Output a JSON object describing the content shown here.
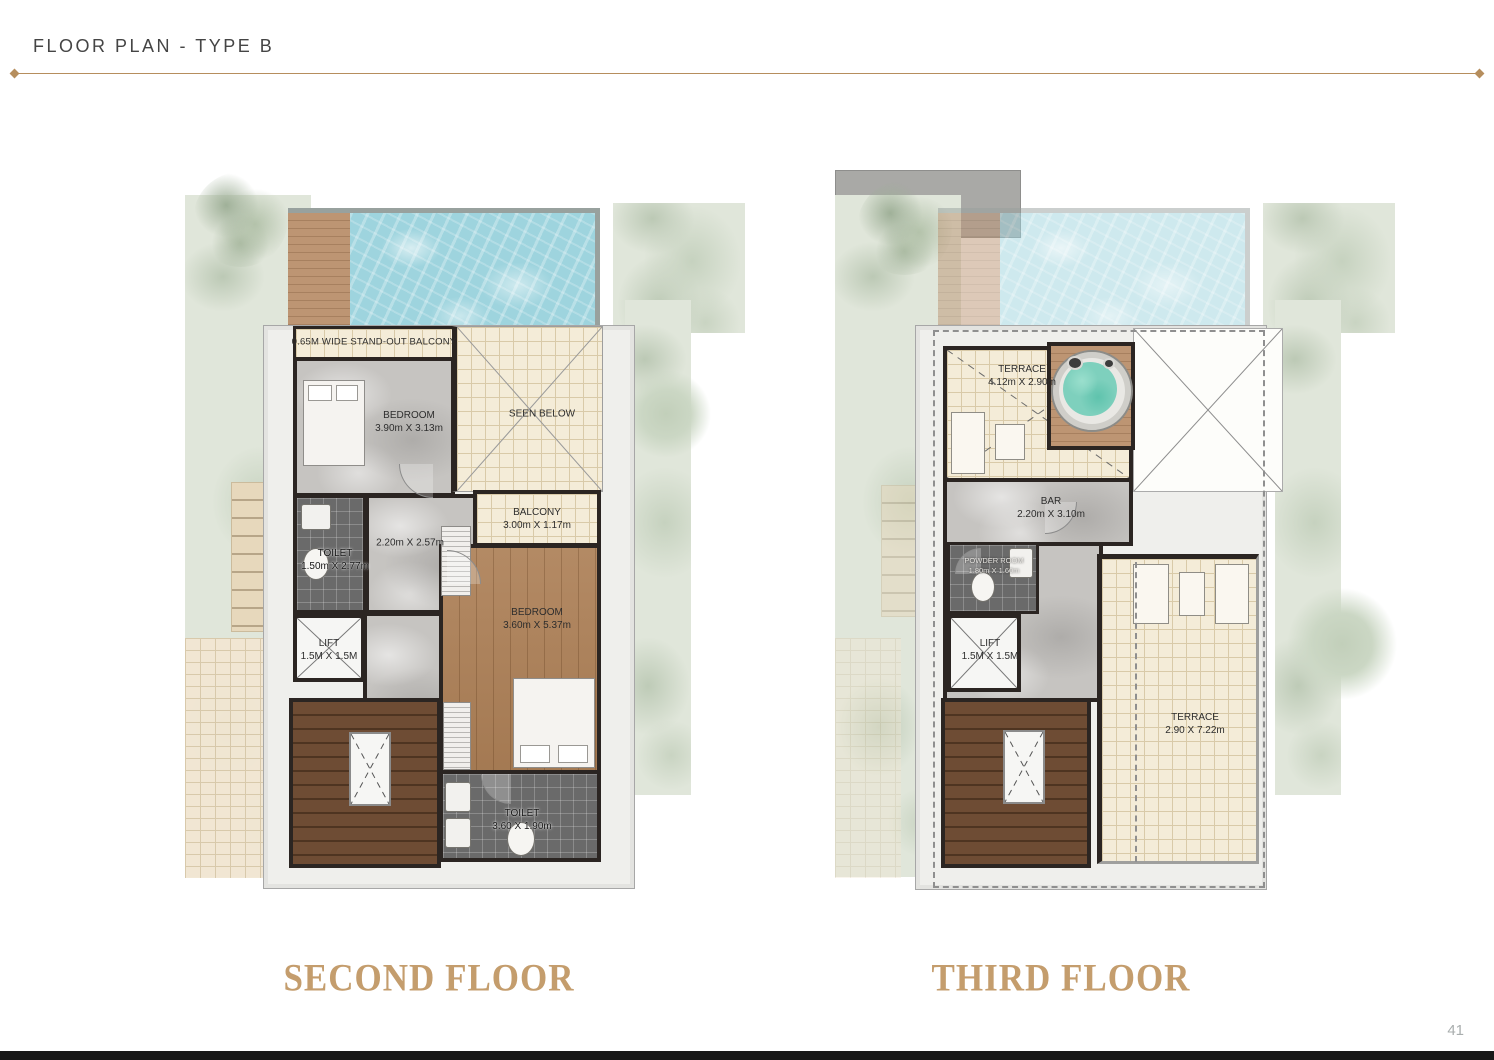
{
  "page": {
    "title": "FLOOR PLAN - TYPE B",
    "page_number": "41"
  },
  "colors": {
    "accent_gold": "#b68e5d",
    "caption_gold": "#c49d6d",
    "pool_blue": "#9ed4de",
    "wall_dark": "#2b2522",
    "greenery": "#e0e6da",
    "cream_tile": "#f4ecd8"
  },
  "second_floor": {
    "caption": "SECOND FLOOR",
    "rooms": {
      "standout_balcony": {
        "label": "0.65M WIDE STAND-OUT BALCONY"
      },
      "bedroom_front": {
        "name": "BEDROOM",
        "dims": "3.90m X 3.13m"
      },
      "seen_below": {
        "label": "SEEN BELOW"
      },
      "balcony": {
        "name": "BALCONY",
        "dims": "3.00m X 1.17m"
      },
      "toilet_upper": {
        "name": "TOILET",
        "dims": "1.50m X 2.77m"
      },
      "hall": {
        "dims": "2.20m X 2.57m"
      },
      "bedroom_master": {
        "name": "BEDROOM",
        "dims": "3.60m X 5.37m"
      },
      "lift": {
        "name": "LIFT",
        "dims": "1.5M X 1.5M"
      },
      "toilet_lower": {
        "name": "TOILET",
        "dims": "3.60 X 1.90m"
      }
    }
  },
  "third_floor": {
    "caption": "THIRD FLOOR",
    "rooms": {
      "terrace_upper": {
        "name": "TERRACE",
        "dims": "4.12m X 2.90m"
      },
      "bar": {
        "name": "BAR",
        "dims": "2.20m X 3.10m"
      },
      "powder_room": {
        "name": "POWDER ROOM",
        "dims": "1.80m X 1.60m"
      },
      "lift": {
        "name": "LIFT",
        "dims": "1.5M X 1.5M"
      },
      "terrace_main": {
        "name": "TERRACE",
        "dims": "2.90 X 7.22m"
      }
    }
  }
}
